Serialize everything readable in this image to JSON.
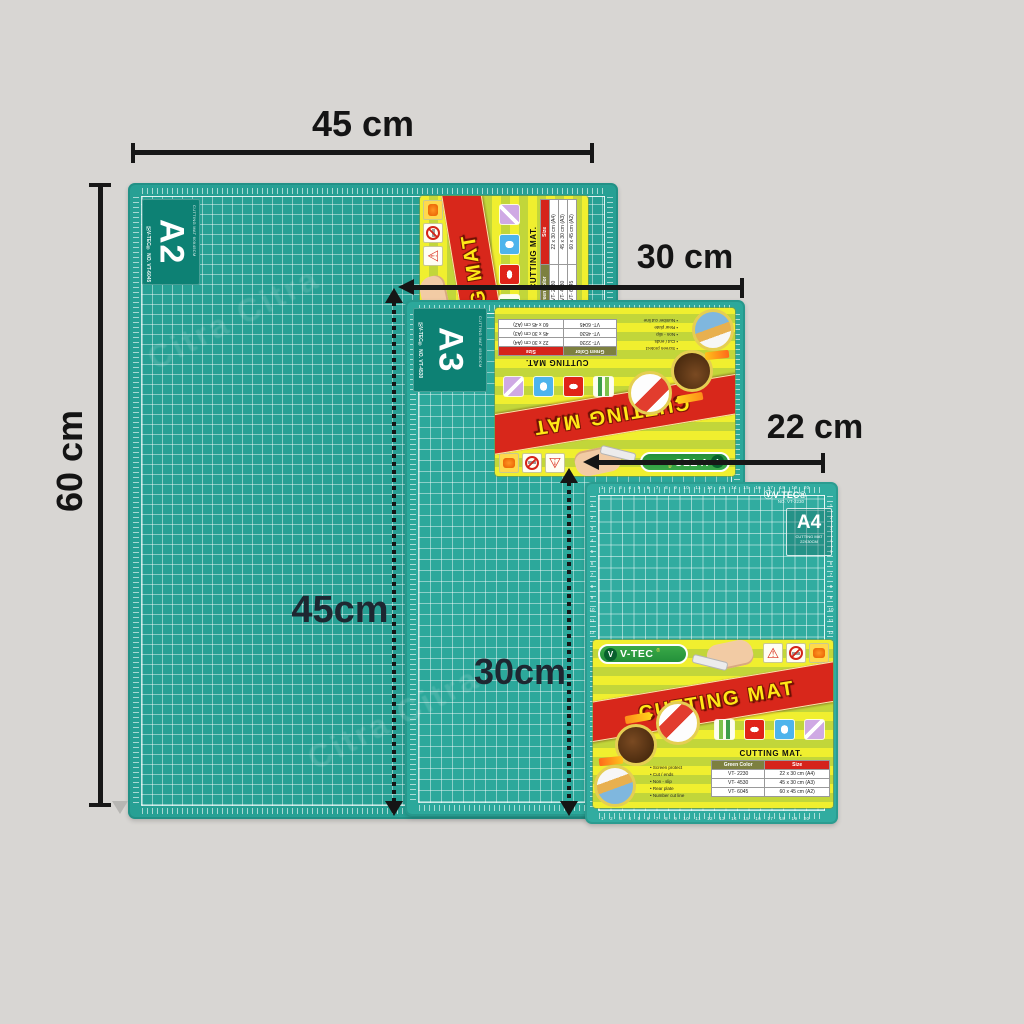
{
  "scene": {
    "background": "#d8d6d3"
  },
  "annotations": {
    "a2_width": "45 cm",
    "a2_height": "60 cm",
    "a3_width": "30 cm",
    "a3_height": "45cm",
    "a4_width": "22 cm",
    "a4_height": "30cm"
  },
  "mats": {
    "a2": {
      "grade": "A2",
      "corner_sub": "CUTTING MAT 60X45CM",
      "brand_line": "ⓋV-TEC® NO. VT-6045"
    },
    "a3": {
      "grade": "A3",
      "corner_sub": "CUTTING MAT 45X30CM",
      "brand_line": "ⓋV-TEC® NO. VT-4530"
    },
    "a4": {
      "grade": "A4",
      "brand": "ⓋV-TEC®",
      "model": "NO. VT-2230",
      "sub1": "CUTTING MAT",
      "sub2": "22X30CM"
    }
  },
  "rulers": {
    "h20": "1 2 3 4 5 6 7 8 9 10 11 12 13 14 15 16 17 18 19 20",
    "v12": "1\n2\n3\n4\n5\n6\n7\n8\n9\n10\n11\n12"
  },
  "label": {
    "vmark": "V",
    "brand": "V-TEC",
    "reg": "®",
    "warn": "⚠",
    "banner": "CUTTING MAT",
    "table_title": "CUTTING MAT.",
    "col1": "Green Color",
    "col2": "Size",
    "rows": [
      {
        "code": "VT- 2230",
        "size": "22 x 30 cm (A4)"
      },
      {
        "code": "VT- 4530",
        "size": "45 x 30 cm (A3)"
      },
      {
        "code": "VT- 6045",
        "size": "60 x 45 cm (A2)"
      }
    ],
    "features": [
      "Screen protect",
      "Cut / ends",
      "Non - slip",
      "Rear plate",
      "Number cut line"
    ]
  },
  "watermark": {
    "text": "Citra Citra"
  }
}
